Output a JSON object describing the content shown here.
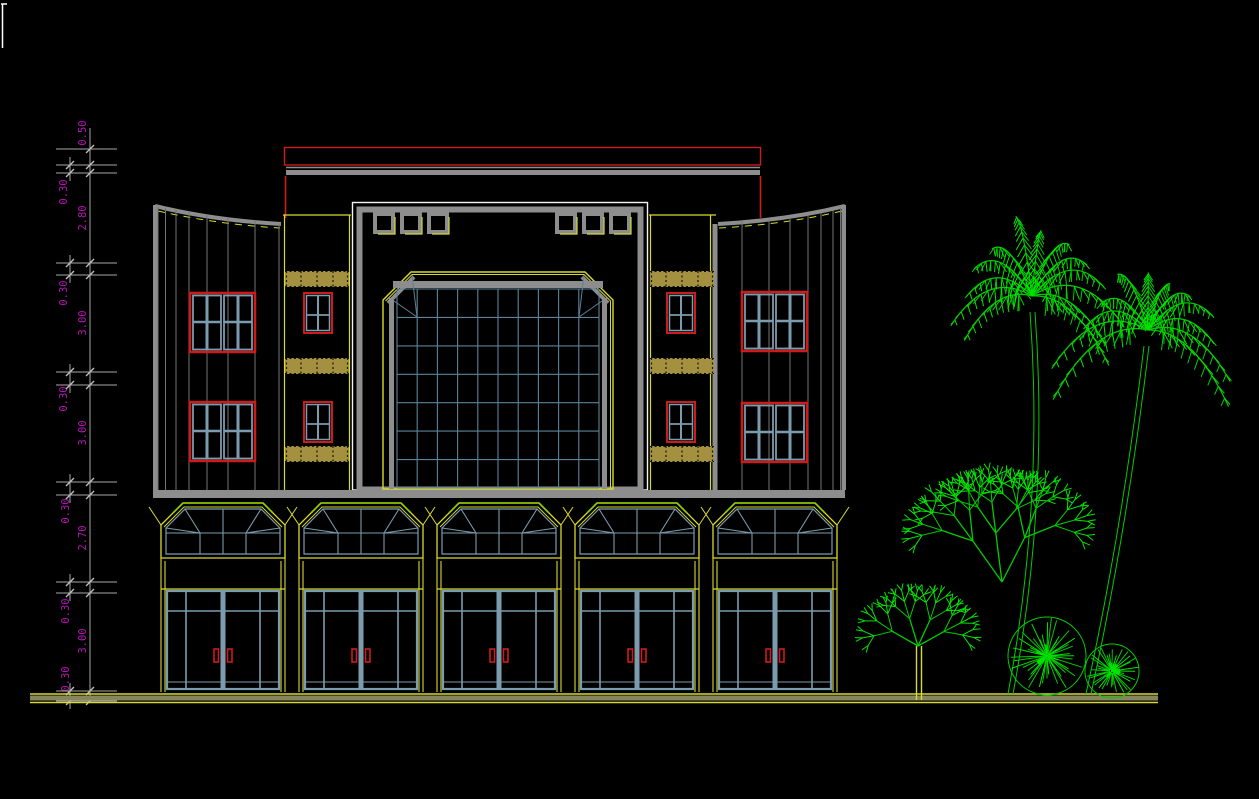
{
  "drawing": {
    "type": "building-front-elevation",
    "style": "cad-wireframe-on-black",
    "shopfront_bays": 5,
    "roof_vent_squares": 6,
    "wing_large_windows": 4,
    "strip_small_windows": 4
  },
  "dims": [
    "0.50",
    "0.30",
    "2.80",
    "0.30",
    "3.00",
    "0.30",
    "3.00",
    "0.30",
    "2.70",
    "0.30",
    "3.00",
    "0.30"
  ],
  "colors": {
    "background": "#000000",
    "dimension_text": "#b513b5",
    "dimension_lines": "#a9a9a9",
    "cad_red": "#cf1a1a",
    "cad_yellow": "#d9d930",
    "accent_green": "#90d200",
    "tree_green": "#00cc00",
    "steel_blue_mullion": "#7a9cae",
    "curtain_grid": "#5b8298",
    "wall_gray": "#8d8d8d",
    "khaki_band": "#a3913f",
    "ground_olive": "#85855e",
    "white": "#ffffff"
  },
  "vegetation": {
    "color": "#00cc00",
    "palms": [
      {
        "cx": 1032,
        "cy": 296,
        "radius": 92,
        "fronds": 13,
        "seed": 3,
        "trunk": [
          [
            1030,
            312
          ],
          [
            1044,
            500
          ],
          [
            1008,
            694
          ]
        ],
        "trunk2": [
          [
            1035,
            312
          ],
          [
            1049,
            500
          ],
          [
            1013,
            694
          ]
        ]
      },
      {
        "cx": 1148,
        "cy": 330,
        "radius": 90,
        "fronds": 12,
        "seed": 9,
        "trunk": [
          [
            1144,
            346
          ],
          [
            1122,
            530
          ],
          [
            1086,
            694
          ]
        ],
        "trunk2": [
          [
            1149,
            346
          ],
          [
            1127,
            530
          ],
          [
            1091,
            694
          ]
        ]
      }
    ],
    "branch_trees": [
      {
        "x": 1002,
        "y": 582,
        "stems": 3,
        "len": 52,
        "depth": 5,
        "spread": 38,
        "seed": 11
      },
      {
        "x": 918,
        "y": 646,
        "stems": 4,
        "len": 30,
        "depth": 4,
        "spread": 46,
        "seed": 5,
        "trunk_color": "#d9d930",
        "trunk": [
          [
            916.5,
            646
          ],
          [
            916.5,
            700
          ],
          [
            921.5,
            646
          ],
          [
            921.5,
            700
          ]
        ]
      }
    ],
    "starburst_bushes": [
      {
        "cx": 1047,
        "cy": 656,
        "r": 39,
        "spokes": 40,
        "seed": 21
      },
      {
        "cx": 1112,
        "cy": 671,
        "r": 27,
        "spokes": 34,
        "seed": 33
      }
    ]
  },
  "dim_chain": {
    "unit_note": "meters-implied",
    "levels_px": [
      149,
      165,
      173,
      263,
      275,
      372,
      385,
      482,
      495,
      582,
      593,
      691,
      701
    ]
  }
}
